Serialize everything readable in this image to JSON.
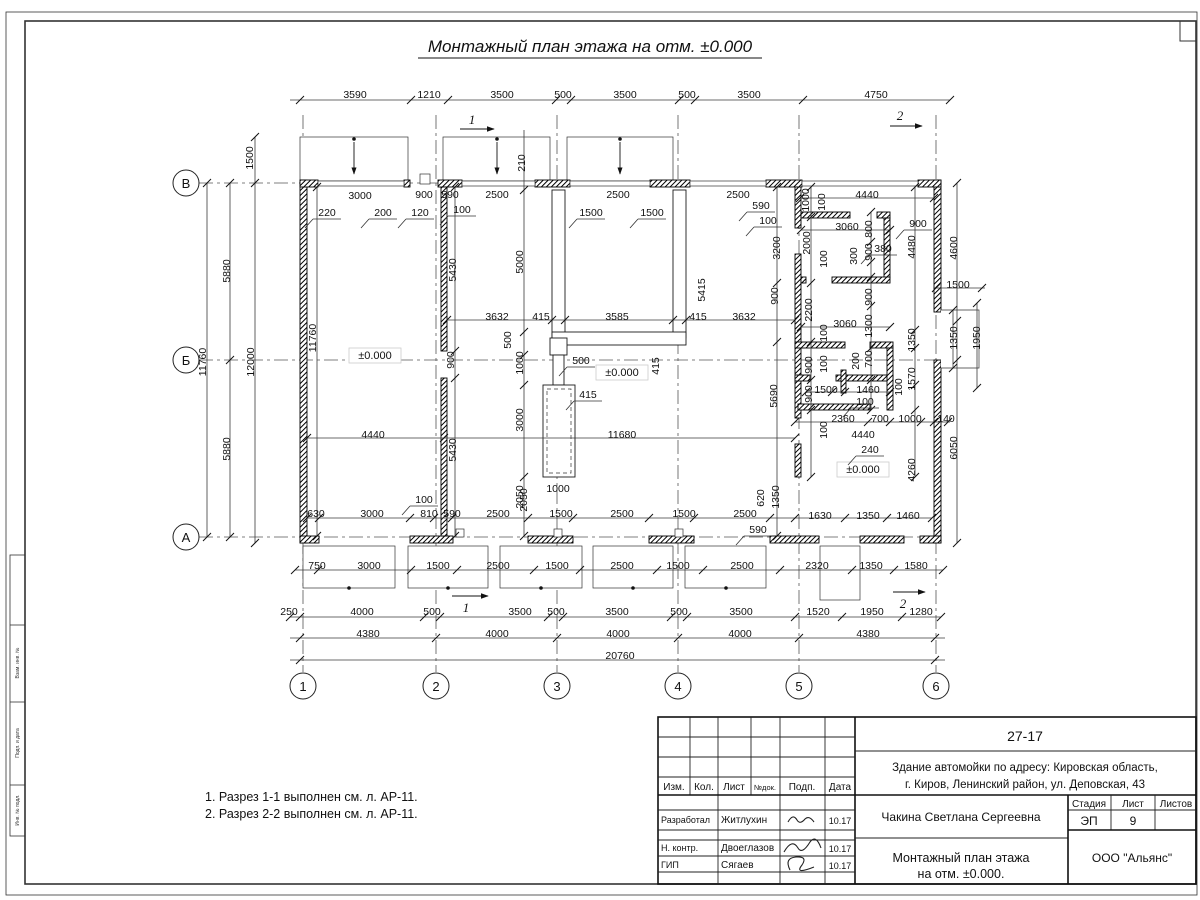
{
  "title": "Монтажный план этажа на отм. ±0.000",
  "notes": [
    "1. Разрез 1-1 выполнен см. л. АР-11.",
    "2. Разрез 2-2 выполнен см. л. АР-11."
  ],
  "axes": {
    "rows": [
      "В",
      "Б",
      "А"
    ],
    "cols": [
      "1",
      "2",
      "3",
      "4",
      "5",
      "6"
    ]
  },
  "section_markers": [
    "1",
    "2"
  ],
  "levels": [
    "±0.000",
    "±0.000",
    "±0.000"
  ],
  "side_stamp": [
    "Взам. инв. №",
    "Подп. и дата",
    "Инв. № подл."
  ],
  "title_block": {
    "doc_number": "27-17",
    "project_line1": "Здание автомойки по адресу: Кировская область,",
    "project_line2": "г. Киров, Ленинский район, ул. Деповская, 43",
    "header_cols": [
      "Изм.",
      "Кол.",
      "Лист",
      "№док.",
      "Подп.",
      "Дата"
    ],
    "rows": [
      {
        "role": "Разработал",
        "name": "Житлухин",
        "date": "10.17"
      },
      {
        "role": "Н. контр.",
        "name": "Двоеглазов",
        "date": "10.17"
      },
      {
        "role": "ГИП",
        "name": "Сягаев",
        "date": "10.17"
      }
    ],
    "engineer": "Чакина Светлана Сергеевна",
    "stage_labels": [
      "Стадия",
      "Лист",
      "Листов"
    ],
    "stage": "ЭП",
    "sheet_num": "9",
    "drawing_title_line1": "Монтажный план этажа",
    "drawing_title_line2": "на отм. ±0.000.",
    "company": "ООО \"Альянс\""
  },
  "dim_labels": [
    {
      "t": "3590",
      "x": 355,
      "y": 94
    },
    {
      "t": "1210",
      "x": 429,
      "y": 94
    },
    {
      "t": "3500",
      "x": 502,
      "y": 94
    },
    {
      "t": "500",
      "x": 563,
      "y": 94
    },
    {
      "t": "3500",
      "x": 625,
      "y": 94
    },
    {
      "t": "500",
      "x": 687,
      "y": 94
    },
    {
      "t": "3500",
      "x": 749,
      "y": 94
    },
    {
      "t": "4750",
      "x": 876,
      "y": 94
    },
    {
      "t": "1500",
      "x": 249,
      "y": 158,
      "v": 1
    },
    {
      "t": "11760",
      "x": 202,
      "y": 362,
      "v": 1
    },
    {
      "t": "5880",
      "x": 226,
      "y": 271,
      "v": 1
    },
    {
      "t": "5880",
      "x": 226,
      "y": 449,
      "v": 1
    },
    {
      "t": "12000",
      "x": 250,
      "y": 362,
      "v": 1
    },
    {
      "t": "11760",
      "x": 312,
      "y": 338,
      "v": 1
    },
    {
      "t": "3000",
      "x": 360,
      "y": 195
    },
    {
      "t": "900",
      "x": 424,
      "y": 194
    },
    {
      "t": "590",
      "x": 450,
      "y": 194
    },
    {
      "t": "2500",
      "x": 497,
      "y": 194
    },
    {
      "t": "2500",
      "x": 618,
      "y": 194
    },
    {
      "t": "2500",
      "x": 738,
      "y": 194
    },
    {
      "t": "4440",
      "x": 867,
      "y": 194
    },
    {
      "t": "220",
      "x": 327,
      "y": 212,
      "ld": 1
    },
    {
      "t": "200",
      "x": 383,
      "y": 212,
      "ld": 1
    },
    {
      "t": "120",
      "x": 420,
      "y": 212,
      "ld": 1
    },
    {
      "t": "100",
      "x": 462,
      "y": 209,
      "ld": 1
    },
    {
      "t": "590",
      "x": 761,
      "y": 205,
      "ld": 1
    },
    {
      "t": "100",
      "x": 768,
      "y": 220,
      "ld": 1
    },
    {
      "t": "210",
      "x": 521,
      "y": 163,
      "v": 1
    },
    {
      "t": "1500",
      "x": 591,
      "y": 212,
      "ld": 1
    },
    {
      "t": "1500",
      "x": 652,
      "y": 212,
      "ld": 1
    },
    {
      "t": "5000",
      "x": 519,
      "y": 262,
      "v": 1
    },
    {
      "t": "5415",
      "x": 701,
      "y": 290,
      "v": 1
    },
    {
      "t": "5430",
      "x": 452,
      "y": 270,
      "v": 1
    },
    {
      "t": "900",
      "x": 450,
      "y": 360,
      "v": 1
    },
    {
      "t": "5430",
      "x": 452,
      "y": 450,
      "v": 1
    },
    {
      "t": "3632",
      "x": 497,
      "y": 316
    },
    {
      "t": "415",
      "x": 541,
      "y": 316
    },
    {
      "t": "3585",
      "x": 617,
      "y": 316
    },
    {
      "t": "415",
      "x": 698,
      "y": 316
    },
    {
      "t": "3632",
      "x": 744,
      "y": 316
    },
    {
      "t": "500",
      "x": 507,
      "y": 340,
      "v": 1
    },
    {
      "t": "1000",
      "x": 519,
      "y": 363,
      "v": 1
    },
    {
      "t": "500",
      "x": 581,
      "y": 360,
      "ld": 1
    },
    {
      "t": "415",
      "x": 588,
      "y": 394,
      "ld": 1
    },
    {
      "t": "415",
      "x": 655,
      "y": 366,
      "v": 1
    },
    {
      "t": "3000",
      "x": 519,
      "y": 420,
      "v": 1
    },
    {
      "t": "1000",
      "x": 558,
      "y": 488
    },
    {
      "t": "2050",
      "x": 519,
      "y": 497,
      "v": 1
    },
    {
      "t": "100",
      "x": 424,
      "y": 499,
      "ld": 1
    },
    {
      "t": "4440",
      "x": 373,
      "y": 434
    },
    {
      "t": "11680",
      "x": 622,
      "y": 434
    },
    {
      "t": "1000",
      "x": 805,
      "y": 200,
      "v": 1
    },
    {
      "t": "100",
      "x": 821,
      "y": 202,
      "v": 1
    },
    {
      "t": "3060",
      "x": 847,
      "y": 226
    },
    {
      "t": "800",
      "x": 868,
      "y": 229,
      "v": 1
    },
    {
      "t": "900",
      "x": 918,
      "y": 223,
      "ld": 1
    },
    {
      "t": "380",
      "x": 883,
      "y": 248,
      "ld": 1
    },
    {
      "t": "4480",
      "x": 911,
      "y": 247,
      "v": 1
    },
    {
      "t": "4600",
      "x": 953,
      "y": 248,
      "v": 1
    },
    {
      "t": "3200",
      "x": 776,
      "y": 248,
      "v": 1
    },
    {
      "t": "2000",
      "x": 806,
      "y": 243,
      "v": 1
    },
    {
      "t": "100",
      "x": 823,
      "y": 259,
      "v": 1
    },
    {
      "t": "300",
      "x": 853,
      "y": 256,
      "v": 1
    },
    {
      "t": "900",
      "x": 868,
      "y": 252,
      "v": 1
    },
    {
      "t": "900",
      "x": 774,
      "y": 296,
      "v": 1
    },
    {
      "t": "2200",
      "x": 808,
      "y": 310,
      "v": 1
    },
    {
      "t": "1500",
      "x": 958,
      "y": 284
    },
    {
      "t": "900",
      "x": 868,
      "y": 297,
      "v": 1
    },
    {
      "t": "3060",
      "x": 845,
      "y": 323
    },
    {
      "t": "1300",
      "x": 868,
      "y": 326,
      "v": 1
    },
    {
      "t": "1350",
      "x": 911,
      "y": 340,
      "v": 1
    },
    {
      "t": "1350",
      "x": 953,
      "y": 338,
      "v": 1
    },
    {
      "t": "1950",
      "x": 976,
      "y": 338,
      "v": 1
    },
    {
      "t": "100",
      "x": 823,
      "y": 333,
      "v": 1
    },
    {
      "t": "900",
      "x": 808,
      "y": 365,
      "v": 1
    },
    {
      "t": "100",
      "x": 823,
      "y": 364,
      "v": 1
    },
    {
      "t": "200",
      "x": 855,
      "y": 361,
      "v": 1
    },
    {
      "t": "700",
      "x": 868,
      "y": 359,
      "v": 1
    },
    {
      "t": "1570",
      "x": 911,
      "y": 379,
      "v": 1
    },
    {
      "t": "5690",
      "x": 773,
      "y": 396,
      "v": 1
    },
    {
      "t": "900",
      "x": 808,
      "y": 394,
      "v": 1
    },
    {
      "t": "1500",
      "x": 826,
      "y": 389
    },
    {
      "t": "1460",
      "x": 868,
      "y": 389
    },
    {
      "t": "100",
      "x": 865,
      "y": 401,
      "ld": 1
    },
    {
      "t": "100",
      "x": 898,
      "y": 387,
      "v": 1
    },
    {
      "t": "2360",
      "x": 843,
      "y": 418
    },
    {
      "t": "700",
      "x": 880,
      "y": 418
    },
    {
      "t": "1000",
      "x": 910,
      "y": 418
    },
    {
      "t": "140",
      "x": 946,
      "y": 418
    },
    {
      "t": "4440",
      "x": 863,
      "y": 434
    },
    {
      "t": "100",
      "x": 823,
      "y": 430,
      "v": 1
    },
    {
      "t": "240",
      "x": 870,
      "y": 449,
      "ld": 1
    },
    {
      "t": "4260",
      "x": 911,
      "y": 470,
      "v": 1
    },
    {
      "t": "6050",
      "x": 953,
      "y": 448,
      "v": 1
    },
    {
      "t": "620",
      "x": 760,
      "y": 498,
      "v": 1
    },
    {
      "t": "1350",
      "x": 775,
      "y": 497,
      "v": 1
    },
    {
      "t": "590",
      "x": 758,
      "y": 529,
      "ld": 1
    },
    {
      "t": "1630",
      "x": 820,
      "y": 515
    },
    {
      "t": "1350",
      "x": 868,
      "y": 515
    },
    {
      "t": "1460",
      "x": 908,
      "y": 515
    },
    {
      "t": "630",
      "x": 316,
      "y": 513
    },
    {
      "t": "3000",
      "x": 372,
      "y": 513
    },
    {
      "t": "810",
      "x": 429,
      "y": 513
    },
    {
      "t": "590",
      "x": 452,
      "y": 513
    },
    {
      "t": "2500",
      "x": 498,
      "y": 513
    },
    {
      "t": "1500",
      "x": 561,
      "y": 513
    },
    {
      "t": "2500",
      "x": 622,
      "y": 513
    },
    {
      "t": "1500",
      "x": 684,
      "y": 513
    },
    {
      "t": "2500",
      "x": 745,
      "y": 513
    },
    {
      "t": "2050",
      "x": 523,
      "y": 500,
      "v": 1
    },
    {
      "t": "750",
      "x": 317,
      "y": 565
    },
    {
      "t": "3000",
      "x": 369,
      "y": 565
    },
    {
      "t": "1500",
      "x": 438,
      "y": 565
    },
    {
      "t": "2500",
      "x": 498,
      "y": 565
    },
    {
      "t": "1500",
      "x": 557,
      "y": 565
    },
    {
      "t": "2500",
      "x": 622,
      "y": 565
    },
    {
      "t": "1500",
      "x": 678,
      "y": 565
    },
    {
      "t": "2500",
      "x": 742,
      "y": 565
    },
    {
      "t": "2320",
      "x": 817,
      "y": 565
    },
    {
      "t": "1350",
      "x": 871,
      "y": 565
    },
    {
      "t": "1580",
      "x": 916,
      "y": 565
    },
    {
      "t": "250",
      "x": 289,
      "y": 611
    },
    {
      "t": "4000",
      "x": 362,
      "y": 611
    },
    {
      "t": "500",
      "x": 432,
      "y": 611
    },
    {
      "t": "3500",
      "x": 520,
      "y": 611
    },
    {
      "t": "500",
      "x": 556,
      "y": 611
    },
    {
      "t": "3500",
      "x": 617,
      "y": 611
    },
    {
      "t": "500",
      "x": 679,
      "y": 611
    },
    {
      "t": "3500",
      "x": 741,
      "y": 611
    },
    {
      "t": "1520",
      "x": 818,
      "y": 611
    },
    {
      "t": "1950",
      "x": 872,
      "y": 611
    },
    {
      "t": "1280",
      "x": 921,
      "y": 611
    },
    {
      "t": "4380",
      "x": 368,
      "y": 633
    },
    {
      "t": "4000",
      "x": 497,
      "y": 633
    },
    {
      "t": "4000",
      "x": 618,
      "y": 633
    },
    {
      "t": "4000",
      "x": 740,
      "y": 633
    },
    {
      "t": "4380",
      "x": 868,
      "y": 633
    },
    {
      "t": "20760",
      "x": 620,
      "y": 655
    }
  ]
}
